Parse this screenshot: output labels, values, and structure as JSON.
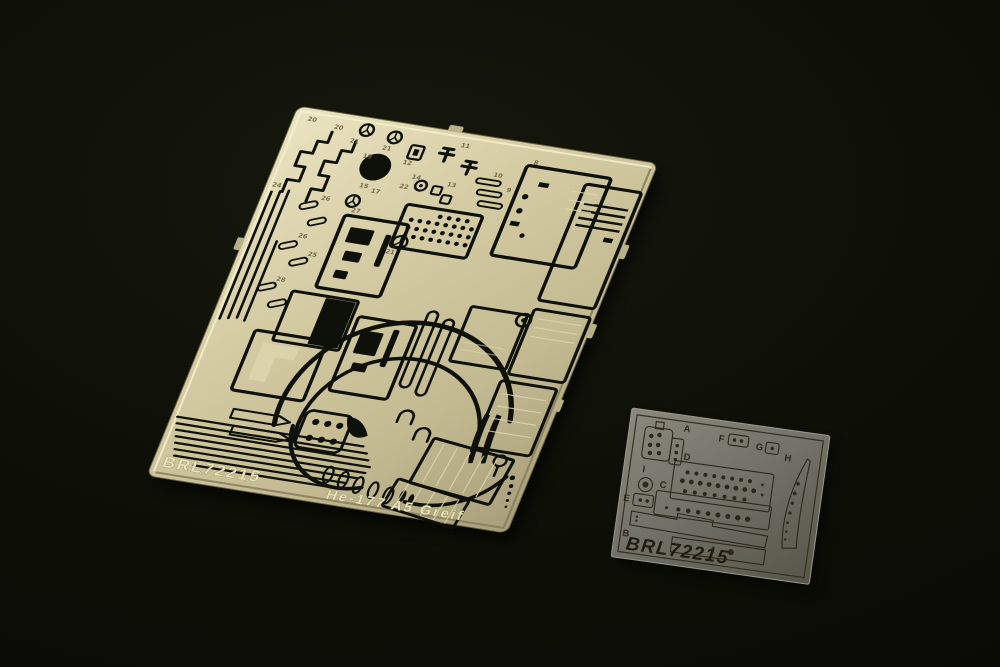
{
  "photo": {
    "background_color": "#0e1007",
    "shadow_color": "#000000"
  },
  "large_fret": {
    "code": "BRL72215",
    "subject": "He-177 A5 Greif",
    "material_color": "#c9bf97",
    "cutout_color": "#0e100a",
    "part_numbers": [
      "20",
      "20",
      "21",
      "21",
      "19",
      "12",
      "11",
      "14",
      "13",
      "10",
      "9",
      "8",
      "15",
      "17",
      "22",
      "21",
      "26",
      "26",
      "25",
      "28",
      "24",
      "27"
    ]
  },
  "small_fret": {
    "code": "BRL72215",
    "material_color": "#767469",
    "print_color": "#2e2819",
    "section_labels": [
      "A",
      "B",
      "C",
      "D",
      "E",
      "F",
      "G",
      "H",
      "I"
    ]
  }
}
